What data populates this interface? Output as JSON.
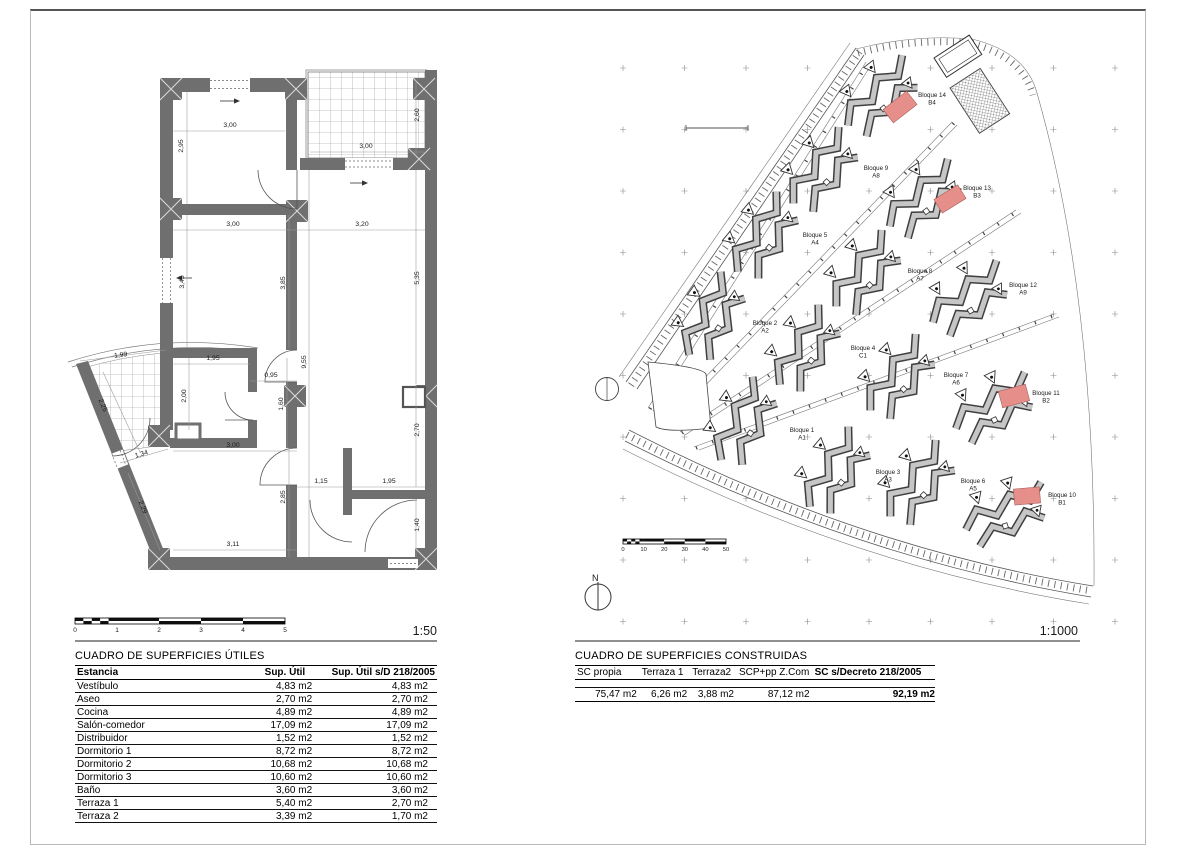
{
  "sheet": {
    "fp_scale": "1:50",
    "sp_scale": "1:1000",
    "north": "N"
  },
  "floor_plan": {
    "scale_ticks": [
      "0",
      "1",
      "2",
      "3",
      "4",
      "5"
    ],
    "dims": [
      {
        "t": "3,00",
        "x": 230,
        "y": 127,
        "r": 0
      },
      {
        "t": "2,95",
        "x": 183,
        "y": 146,
        "r": -90
      },
      {
        "t": "2,60",
        "x": 419,
        "y": 115,
        "r": -90
      },
      {
        "t": "3,00",
        "x": 366,
        "y": 148,
        "r": 0
      },
      {
        "t": "3,00",
        "x": 233,
        "y": 226,
        "r": 0
      },
      {
        "t": "3,20",
        "x": 362,
        "y": 226,
        "r": 0
      },
      {
        "t": "3,45",
        "x": 184,
        "y": 282,
        "r": -90
      },
      {
        "t": "3,85",
        "x": 285,
        "y": 283,
        "r": -90
      },
      {
        "t": "5,35",
        "x": 419,
        "y": 278,
        "r": -90
      },
      {
        "t": "1,95",
        "x": 213,
        "y": 360,
        "r": 0
      },
      {
        "t": "9,55",
        "x": 306,
        "y": 362,
        "r": -90
      },
      {
        "t": "0,95",
        "x": 271,
        "y": 377,
        "r": 0
      },
      {
        "t": "2,00",
        "x": 186,
        "y": 396,
        "r": -90
      },
      {
        "t": "1,60",
        "x": 283,
        "y": 404,
        "r": -90
      },
      {
        "t": "1,99",
        "x": 121,
        "y": 357,
        "r": -7
      },
      {
        "t": "2,25",
        "x": 101,
        "y": 406,
        "r": 67
      },
      {
        "t": "1,34",
        "x": 142,
        "y": 456,
        "r": -17
      },
      {
        "t": "3,00",
        "x": 233,
        "y": 447,
        "r": 0
      },
      {
        "t": "2,29",
        "x": 141,
        "y": 508,
        "r": 67
      },
      {
        "t": "2,85",
        "x": 285,
        "y": 497,
        "r": -90
      },
      {
        "t": "1,15",
        "x": 321,
        "y": 483,
        "r": 0
      },
      {
        "t": "1,95",
        "x": 389,
        "y": 483,
        "r": 0
      },
      {
        "t": "2,70",
        "x": 419,
        "y": 430,
        "r": -90
      },
      {
        "t": "1,40",
        "x": 419,
        "y": 525,
        "r": -90
      },
      {
        "t": "3,11",
        "x": 233,
        "y": 546,
        "r": 0
      }
    ]
  },
  "site_plan": {
    "scale_ticks": [
      "0",
      "10",
      "20",
      "30",
      "40",
      "50"
    ],
    "highlight_color": "#e58e8a",
    "blocks": [
      {
        "name": "Bloque 1",
        "code": "A1",
        "x": 802,
        "y": 432
      },
      {
        "name": "Bloque 2",
        "code": "A2",
        "x": 765,
        "y": 325
      },
      {
        "name": "Bloque 3",
        "code": "A3",
        "x": 888,
        "y": 474
      },
      {
        "name": "Bloque 4",
        "code": "C1",
        "x": 863,
        "y": 350
      },
      {
        "name": "Bloque 5",
        "code": "A4",
        "x": 815,
        "y": 237
      },
      {
        "name": "Bloque 6",
        "code": "A5",
        "x": 973,
        "y": 483
      },
      {
        "name": "Bloque 7",
        "code": "A6",
        "x": 956,
        "y": 377
      },
      {
        "name": "Bloque 8",
        "code": "A7",
        "x": 920,
        "y": 273
      },
      {
        "name": "Bloque 9",
        "code": "A8",
        "x": 876,
        "y": 170
      },
      {
        "name": "Bloque 10",
        "code": "B1",
        "x": 1062,
        "y": 497
      },
      {
        "name": "Bloque 11",
        "code": "B2",
        "x": 1046,
        "y": 395
      },
      {
        "name": "Bloque 12",
        "code": "A9",
        "x": 1023,
        "y": 287
      },
      {
        "name": "Bloque 13",
        "code": "B3",
        "x": 977,
        "y": 190
      },
      {
        "name": "Bloque 14",
        "code": "B4",
        "x": 932,
        "y": 97
      }
    ],
    "highlights": [
      {
        "block": "Bloque 14",
        "x": 900,
        "y": 107,
        "w": 30,
        "h": 17,
        "r": -38
      },
      {
        "block": "Bloque 13",
        "x": 950,
        "y": 199,
        "w": 28,
        "h": 16,
        "r": -32
      },
      {
        "block": "Bloque 11",
        "x": 1014,
        "y": 396,
        "w": 28,
        "h": 17,
        "r": -15
      },
      {
        "block": "Bloque 10",
        "x": 1027,
        "y": 496,
        "w": 26,
        "h": 16,
        "r": -5
      }
    ]
  },
  "tables": {
    "utiles": {
      "title": "CUADRO DE SUPERFICIES ÚTILES",
      "headers": [
        "Estancia",
        "Sup. Útil",
        "Sup. Útil s/D 218/2005"
      ],
      "rows": [
        [
          "Vestíbulo",
          "4,83 m2",
          "4,83 m2"
        ],
        [
          "Aseo",
          "2,70 m2",
          "2,70 m2"
        ],
        [
          "Cocina",
          "4,89 m2",
          "4,89 m2"
        ],
        [
          "Salón-comedor",
          "17,09 m2",
          "17,09 m2"
        ],
        [
          "Distribuidor",
          "1,52 m2",
          "1,52 m2"
        ],
        [
          "Dormitorio 1",
          "8,72 m2",
          "8,72 m2"
        ],
        [
          "Dormitorio 2",
          "10,68 m2",
          "10,68 m2"
        ],
        [
          "Dormitorio 3",
          "10,60 m2",
          "10,60 m2"
        ],
        [
          "Baño",
          "3,60 m2",
          "3,60 m2"
        ],
        [
          "Terraza 1",
          "5,40 m2",
          "2,70 m2"
        ],
        [
          "Terraza 2",
          "3,39 m2",
          "1,70 m2"
        ]
      ]
    },
    "construidas": {
      "title": "CUADRO DE SUPERFICIES CONSTRUIDAS",
      "headers": [
        "SC propia",
        "Terraza 1",
        "Terraza2",
        "SCP+pp Z.Com",
        "SC s/Decreto 218/2005"
      ],
      "rows": [
        [
          "75,47 m2",
          "6,26 m2",
          "3,88 m2",
          "87,12 m2",
          "92,19 m2"
        ]
      ]
    }
  }
}
